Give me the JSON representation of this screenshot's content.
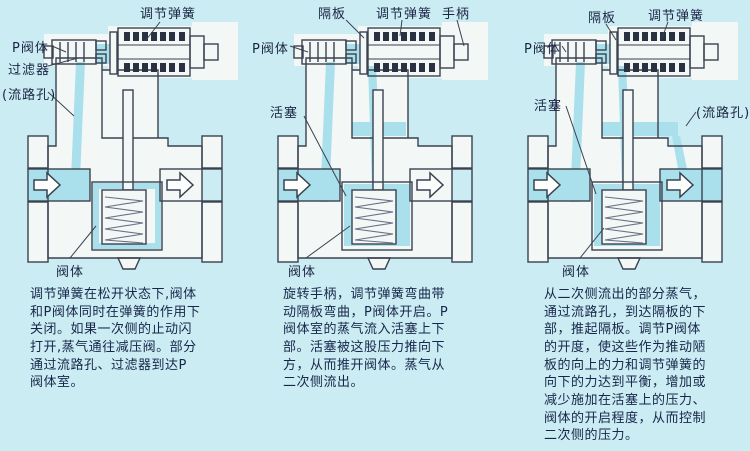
{
  "palette": {
    "background": "#cbecf2",
    "line_color": "#3a4250",
    "steam_flow": "#a9e0ec",
    "body_white": "#f3f7f6",
    "text_color": "#17264a",
    "spring_dark": "#2a3140"
  },
  "panels": [
    {
      "name": "valve-closed-state",
      "labels": [
        {
          "id": "adjust-spring",
          "text": "调节弹簧"
        },
        {
          "id": "p-valve",
          "text": "P阀体"
        },
        {
          "id": "filter",
          "text": "过滤器"
        },
        {
          "id": "flow-hole",
          "text": "(流路孔)"
        },
        {
          "id": "valve-body",
          "text": "阀体"
        }
      ],
      "description": [
        "调节弹簧在松开状态下,阀体",
        "和P阀体同时在弹簧的作用下",
        "关闭。如果一次侧的止动闪",
        "打开,蒸气通往减压阀。部分",
        "通过流路孔、过滤器到达P",
        "阀体室。"
      ]
    },
    {
      "name": "valve-opening-state",
      "labels": [
        {
          "id": "diaphragm",
          "text": "隔板"
        },
        {
          "id": "adjust-spring",
          "text": "调节弹簧"
        },
        {
          "id": "handle",
          "text": "手柄"
        },
        {
          "id": "p-valve",
          "text": "P阀体"
        },
        {
          "id": "piston",
          "text": "活塞"
        },
        {
          "id": "valve-body",
          "text": "阀体"
        }
      ],
      "description": [
        "旋转手柄，调节弹簧弯曲带",
        "动隔板弯曲，P阀体开启。P",
        "阀体室的蒸气流入活塞上下",
        "部。活塞被这股压力推向下",
        "方，从而推开阀体。蒸气从",
        "二次侧流出。"
      ]
    },
    {
      "name": "valve-regulating-state",
      "labels": [
        {
          "id": "diaphragm",
          "text": "隔板"
        },
        {
          "id": "adjust-spring",
          "text": "调节弹簧"
        },
        {
          "id": "p-valve",
          "text": "P阀体"
        },
        {
          "id": "piston",
          "text": "活塞"
        },
        {
          "id": "flow-hole",
          "text": "(流路孔)"
        },
        {
          "id": "valve-body",
          "text": "阀体"
        }
      ],
      "description": [
        "从二次侧流出的部分蒸气，",
        "通过流路孔，到达隔板的下",
        "部，推起隔板。调节P阀体",
        "的开度，使这些作为推动陋",
        "板的向上的力和调节弹簧的",
        "向下的力达到平衡，增加或",
        "减少施加在活塞上的压力、",
        "阀体的开启程度，从而控制",
        "二次侧的压力。"
      ]
    }
  ]
}
